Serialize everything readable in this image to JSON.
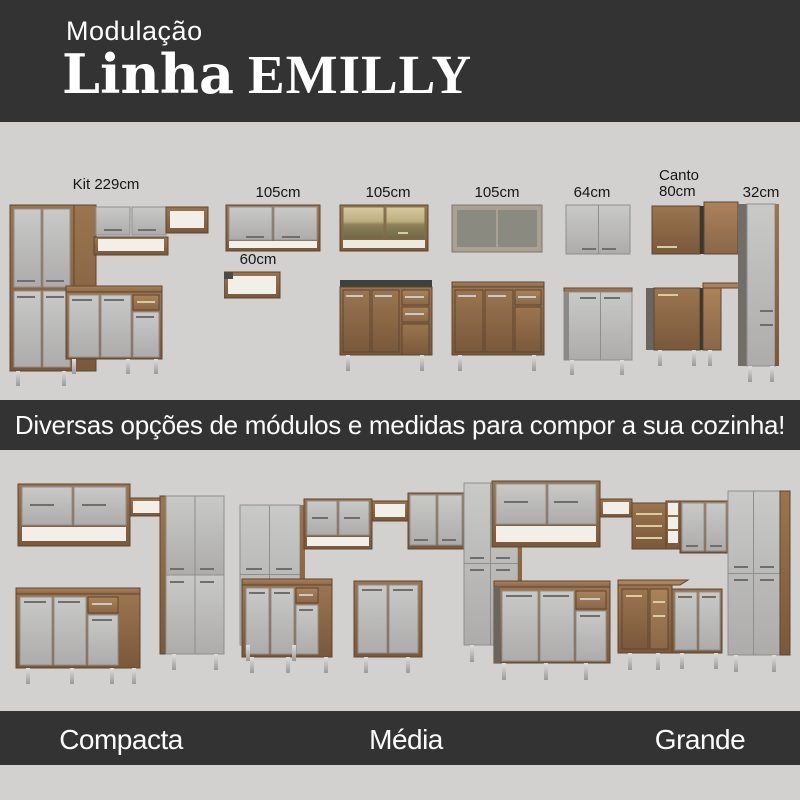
{
  "header": {
    "kicker": "Modulação",
    "title": "Linha",
    "title_accent": "EMILLY"
  },
  "banner": {
    "text": "Diversas opções de módulos e medidas para compor a sua cozinha!"
  },
  "modules": [
    {
      "label": "Kit 229cm"
    },
    {
      "label": "105cm"
    },
    {
      "label": "60cm"
    },
    {
      "label": "105cm"
    },
    {
      "label": "105cm"
    },
    {
      "label": "64cm"
    },
    {
      "label": "Canto 80cm"
    },
    {
      "label": "32cm"
    }
  ],
  "kitchens": [
    {
      "label": "Compacta"
    },
    {
      "label": "Média"
    },
    {
      "label": "Grande"
    }
  ],
  "colors": {
    "banner_bg": "#333333",
    "section_bg": "#d2d1cf",
    "wood": "#8d6a49",
    "door_gray": "#bcbcbc",
    "countertop": "#3c413d",
    "text_light": "#fbfbfb",
    "text_dark": "#161616"
  }
}
